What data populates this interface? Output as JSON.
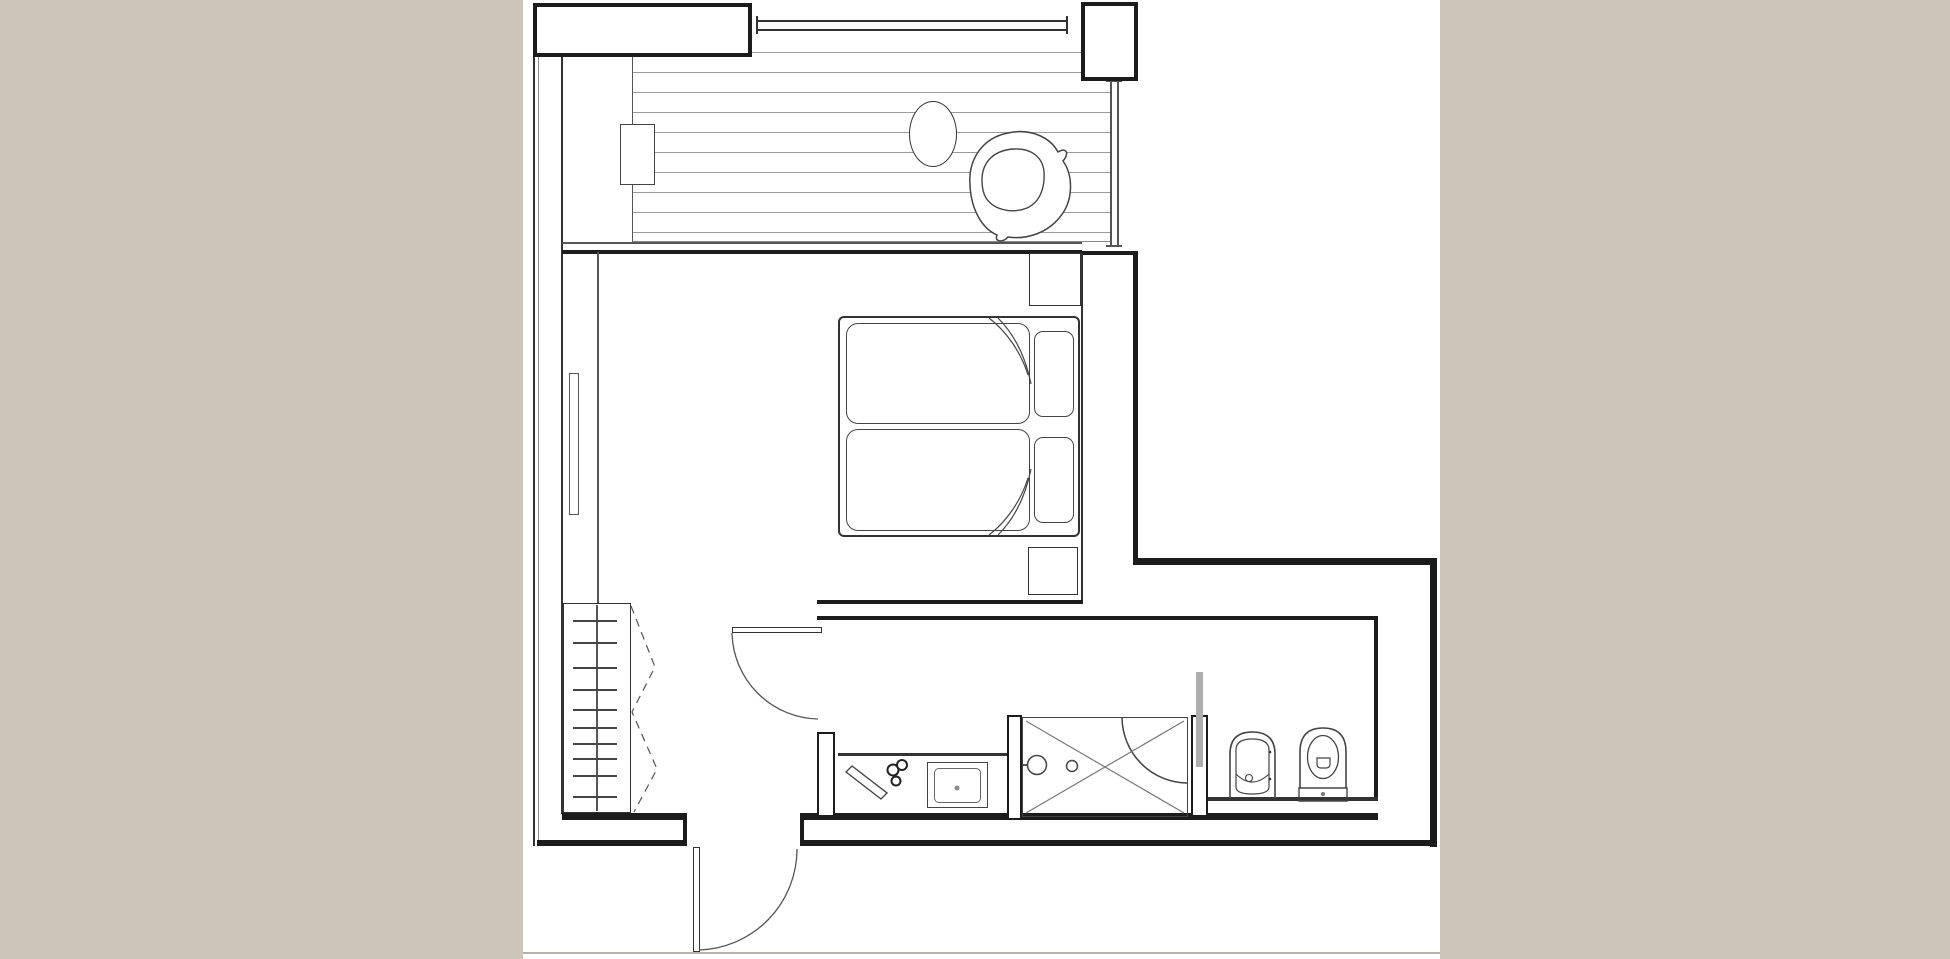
{
  "meta": {
    "kind": "architectural-floor-plan",
    "description": "Black and white studio-apartment floor plan on white paper with warm grey margins; no text labels are rendered in the image",
    "rooms": [
      "balcony-terrace",
      "bedroom",
      "wardrobe-corridor",
      "entry-hall",
      "vanity-niche",
      "shower-area",
      "wc-room"
    ]
  },
  "palette": {
    "page_bg": "#cdc5b7",
    "paper": "#ffffff",
    "wall": "#1c1c1c",
    "wall2": "#333333",
    "medium": "#555555",
    "light": "#8c8c8c",
    "deck_line": "#9b9b9b",
    "glass": "#b0adad",
    "scan": "#b9b3a7",
    "furn": "#444444",
    "thin": "#777777"
  },
  "canvas": {
    "x": 523,
    "y": 0,
    "w": 917,
    "h": 959
  },
  "drawing": {
    "rects": [
      {
        "name": "balcony-decking",
        "x": 632,
        "y": 33,
        "w": 478,
        "h": 209,
        "deck": true,
        "bl": "1.5px solid #555555",
        "bb": "1px solid #888888"
      },
      {
        "name": "balcony-side-table",
        "x": 620,
        "y": 124,
        "w": 35,
        "h": 61,
        "fill": "paper",
        "b": "1.5px solid #444444"
      },
      {
        "name": "wall-block-top-left",
        "x": 533,
        "y": 3,
        "w": 219,
        "h": 54,
        "fill": "paper",
        "b": "4px solid wall"
      },
      {
        "name": "wall-pier-top-right",
        "x": 1081,
        "y": 2,
        "w": 57,
        "h": 79,
        "fill": "paper",
        "b": "4px solid wall"
      },
      {
        "name": "bedroom-right-wall",
        "x": 1081,
        "y": 251,
        "w": 57,
        "h": 314,
        "fill": "paper",
        "bl": "2px solid #333333",
        "br": "5px solid wall",
        "bt": "4px solid wall"
      },
      {
        "name": "balcony-round-table",
        "x": 909,
        "y": 101,
        "w": 48,
        "h": 66,
        "fill": "paper",
        "b": "1.5px solid #333333",
        "rx": "50%"
      },
      {
        "name": "bed-frame",
        "x": 838,
        "y": 316,
        "w": 242,
        "h": 221,
        "fill": "paper",
        "b": "2px solid #333333",
        "rx": "6px"
      },
      {
        "name": "mattress-top",
        "x": 846,
        "y": 323,
        "w": 184,
        "h": 101,
        "fill": "paper",
        "b": "1.5px solid furn",
        "rx": "12px"
      },
      {
        "name": "mattress-bottom",
        "x": 846,
        "y": 429,
        "w": 184,
        "h": 102,
        "fill": "paper",
        "b": "1.5px solid furn",
        "rx": "12px"
      },
      {
        "name": "pillow-top",
        "x": 1034,
        "y": 331,
        "w": 40,
        "h": 86,
        "fill": "paper",
        "b": "1.5px solid furn",
        "rx": "9px"
      },
      {
        "name": "pillow-bottom",
        "x": 1034,
        "y": 437,
        "w": 40,
        "h": 86,
        "fill": "paper",
        "b": "1.5px solid furn",
        "rx": "9px"
      },
      {
        "name": "nightstand-top",
        "x": 1029,
        "y": 253,
        "w": 52,
        "h": 53,
        "fill": "paper",
        "b": "1.5px solid #333333"
      },
      {
        "name": "nightstand-bottom",
        "x": 1028,
        "y": 547,
        "w": 50,
        "h": 48,
        "fill": "paper",
        "b": "1.5px solid #333333"
      },
      {
        "name": "wardrobe",
        "x": 563,
        "y": 603,
        "w": 68,
        "h": 210,
        "fill": "paper",
        "b": "1.5px solid #333333"
      },
      {
        "name": "radiator-left-wall",
        "x": 569,
        "y": 373,
        "w": 10,
        "h": 142,
        "fill": "paper",
        "b": "1px solid #555555"
      },
      {
        "name": "wall-pier-vanity-left",
        "x": 817,
        "y": 732,
        "w": 18,
        "h": 85,
        "fill": "paper",
        "b": "2.5px solid wall"
      },
      {
        "name": "wall-pier-shower-left",
        "x": 1007,
        "y": 715,
        "w": 15,
        "h": 105,
        "fill": "paper",
        "b": "2.5px solid wall"
      },
      {
        "name": "wall-stub-shower-right",
        "x": 1191,
        "y": 715,
        "w": 17,
        "h": 102,
        "fill": "paper",
        "b": "2.5px solid wall"
      },
      {
        "name": "glass-partition",
        "x": 1196,
        "y": 672,
        "w": 7,
        "h": 95,
        "fill": "glass"
      },
      {
        "name": "shower-basin",
        "x": 1022,
        "y": 717,
        "w": 166,
        "h": 100,
        "b": "1.5px solid furn"
      },
      {
        "name": "sink-outer",
        "x": 927,
        "y": 762,
        "w": 61,
        "h": 46,
        "fill": "paper",
        "b": "1.5px solid furn"
      },
      {
        "name": "sink-inner",
        "x": 934,
        "y": 768,
        "w": 47,
        "h": 35,
        "fill": "paper",
        "b": "1px solid #666666",
        "rx": "5px"
      },
      {
        "name": "entrance-door-leaf",
        "x": 693,
        "y": 847,
        "w": 7,
        "h": 105,
        "fill": "paper",
        "b": "1.5px solid #333333"
      },
      {
        "name": "bedroom-door-leaf",
        "x": 732,
        "y": 627,
        "w": 90,
        "h": 6,
        "fill": "paper",
        "b": "1.5px solid #333333"
      }
    ],
    "lines": [
      {
        "name": "wall-left-outer-a",
        "x": 533,
        "y": 57,
        "w": 2,
        "h": 789,
        "c": "wall2"
      },
      {
        "name": "wall-left-outer-b",
        "x": 538,
        "y": 57,
        "w": 1,
        "h": 789,
        "c": "light"
      },
      {
        "name": "wall-left-inner",
        "x": 561,
        "y": 57,
        "w": 2,
        "h": 757,
        "c": "wall2"
      },
      {
        "name": "balcony-window-wall-thin",
        "x": 562,
        "y": 242,
        "w": 520,
        "h": 1.5,
        "c": "medium"
      },
      {
        "name": "balcony-window-wall-main",
        "x": 562,
        "y": 250,
        "w": 520,
        "h": 4,
        "c": "wall"
      },
      {
        "name": "balcony-railing-top-a",
        "x": 757,
        "y": 20,
        "w": 310,
        "h": 2,
        "c": "wall2"
      },
      {
        "name": "balcony-railing-top-b",
        "x": 757,
        "y": 29,
        "w": 310,
        "h": 2,
        "c": "wall2"
      },
      {
        "name": "railing-end-cap-left",
        "x": 756,
        "y": 16,
        "w": 2,
        "h": 18,
        "c": "wall2"
      },
      {
        "name": "railing-end-cap-right",
        "x": 1066,
        "y": 16,
        "w": 2,
        "h": 18,
        "c": "wall2"
      },
      {
        "name": "balcony-glass-right-a",
        "x": 1110,
        "y": 81,
        "w": 1.5,
        "h": 166,
        "c": "medium"
      },
      {
        "name": "balcony-glass-right-b",
        "x": 1117,
        "y": 81,
        "w": 1.5,
        "h": 166,
        "c": "medium"
      },
      {
        "name": "balcony-glass-cap-top",
        "x": 1106,
        "y": 80,
        "w": 16,
        "h": 2,
        "c": "medium"
      },
      {
        "name": "balcony-glass-cap-bottom",
        "x": 1106,
        "y": 245,
        "w": 16,
        "h": 2,
        "c": "medium"
      },
      {
        "name": "wall-top-right-extension",
        "x": 1137,
        "y": 558,
        "w": 300,
        "h": 7,
        "c": "wall"
      },
      {
        "name": "wall-right-exterior",
        "x": 1430,
        "y": 558,
        "w": 7,
        "h": 289,
        "c": "wall"
      },
      {
        "name": "hall-wall-top",
        "x": 817,
        "y": 600,
        "w": 266,
        "h": 4,
        "c": "wall"
      },
      {
        "name": "hall-wall-bottom",
        "x": 817,
        "y": 616,
        "w": 561,
        "h": 4,
        "c": "wall"
      },
      {
        "name": "wc-wall-right-inner",
        "x": 1374,
        "y": 620,
        "w": 4,
        "h": 180,
        "c": "wall"
      },
      {
        "name": "wc-plumbing-ledge",
        "x": 1208,
        "y": 797,
        "w": 170,
        "h": 3.5,
        "c": "wall2"
      },
      {
        "name": "wall-bottom-inner-left",
        "x": 562,
        "y": 813,
        "w": 125,
        "h": 7,
        "c": "wall"
      },
      {
        "name": "wall-bottom-inner-right",
        "x": 804,
        "y": 813,
        "w": 574,
        "h": 7,
        "c": "wall"
      },
      {
        "name": "wall-bottom-outer-left",
        "x": 537,
        "y": 840,
        "w": 146,
        "h": 6,
        "c": "wall"
      },
      {
        "name": "wall-bottom-outer-right",
        "x": 800,
        "y": 840,
        "w": 637,
        "h": 6,
        "c": "wall"
      },
      {
        "name": "entrance-jamb-left",
        "x": 683,
        "y": 820,
        "w": 4,
        "h": 26,
        "c": "wall"
      },
      {
        "name": "entrance-jamb-right",
        "x": 800,
        "y": 813,
        "w": 4,
        "h": 33,
        "c": "wall"
      },
      {
        "name": "bedroom-wall-face-lower",
        "x": 1081,
        "y": 565,
        "w": 2,
        "h": 35,
        "c": "wall2"
      },
      {
        "name": "closet-front-line",
        "x": 597,
        "y": 252,
        "w": 1.5,
        "h": 351,
        "c": "medium"
      },
      {
        "name": "vanity-counter-edge",
        "x": 838,
        "y": 753,
        "w": 169,
        "h": 3,
        "c": "wall2"
      },
      {
        "name": "shower-head-stem",
        "x": 1022,
        "y": 764,
        "w": 7,
        "h": 2,
        "c": "medium"
      },
      {
        "name": "scan-edge-bottom",
        "x": 523,
        "y": 952,
        "w": 917,
        "h": 2,
        "c": "scan"
      }
    ],
    "overlines": [
      {
        "name": "wardrobe-center-line",
        "x": 596,
        "y": 605,
        "w": 1.5,
        "h": 206,
        "c": "medium"
      },
      {
        "name": "wardrobe-hanger-tick",
        "x": 573,
        "y": 620,
        "w": 44,
        "h": 1.5,
        "c": "furn"
      },
      {
        "name": "wardrobe-hanger-tick",
        "x": 573,
        "y": 642,
        "w": 44,
        "h": 1.5,
        "c": "furn"
      },
      {
        "name": "wardrobe-hanger-tick",
        "x": 573,
        "y": 667,
        "w": 44,
        "h": 1.5,
        "c": "furn"
      },
      {
        "name": "wardrobe-hanger-tick",
        "x": 573,
        "y": 689,
        "w": 44,
        "h": 1.5,
        "c": "furn"
      },
      {
        "name": "wardrobe-hanger-tick",
        "x": 573,
        "y": 709,
        "w": 44,
        "h": 1.5,
        "c": "furn"
      },
      {
        "name": "wardrobe-hanger-tick",
        "x": 573,
        "y": 727,
        "w": 44,
        "h": 1.5,
        "c": "furn"
      },
      {
        "name": "wardrobe-hanger-tick",
        "x": 573,
        "y": 743,
        "w": 44,
        "h": 1.5,
        "c": "furn"
      },
      {
        "name": "wardrobe-hanger-tick",
        "x": 573,
        "y": 758,
        "w": 44,
        "h": 1.5,
        "c": "furn"
      },
      {
        "name": "wardrobe-hanger-tick",
        "x": 573,
        "y": 775,
        "w": 44,
        "h": 1.5,
        "c": "furn"
      },
      {
        "name": "wardrobe-hanger-tick",
        "x": 573,
        "y": 796,
        "w": 44,
        "h": 1.5,
        "c": "furn"
      }
    ],
    "paths": [
      {
        "name": "bedroom-door-swing",
        "d": "M732,633 A88,88 0 0 0 818,719",
        "s": "medium",
        "sw": 1.3
      },
      {
        "name": "entrance-door-swing",
        "d": "M699,950 A101,101 0 0 0 797,849",
        "s": "medium",
        "sw": 1.3
      },
      {
        "name": "shower-door-swing",
        "d": "M1122,718 A66,66 0 0 0 1187,783",
        "s": "furn",
        "sw": 1.5
      },
      {
        "name": "wardrobe-door-swing-dashed",
        "d": "M631,606 L655,667 L632,712 L657,769 L634,812",
        "s": "medium",
        "sw": 1.2,
        "dash": "8 6"
      },
      {
        "name": "shower-x-line",
        "d": "M1026,721 L1184,813",
        "s": "thin",
        "sw": 1.2
      },
      {
        "name": "shower-x-line",
        "d": "M1026,813 L1184,721",
        "s": "thin",
        "sw": 1.2
      },
      {
        "name": "blanket-fold-top",
        "d": "M989,318 C1006,331 1021,352 1028,375",
        "s": "furn",
        "sw": 1.2
      },
      {
        "name": "blanket-fold-top",
        "d": "M998,318 C1013,333 1025,354 1031,384",
        "s": "furn",
        "sw": 1.2
      },
      {
        "name": "blanket-fold-bottom",
        "d": "M989,535 C1006,522 1021,501 1028,478",
        "s": "furn",
        "sw": 1.2
      },
      {
        "name": "blanket-fold-bottom",
        "d": "M998,535 C1013,520 1025,499 1031,469",
        "s": "furn",
        "sw": 1.2
      },
      {
        "name": "towel-on-counter",
        "d": "M846,772 L881,799 L887,793 L852,766 Z",
        "s": "furn",
        "sw": 1.4,
        "f": "paper"
      },
      {
        "name": "armchair-outer",
        "d": "M970,185 C968,160 982,138 1008,133 C1030,128 1050,137 1058,152 C1066,147 1070,153 1063,161 C1073,175 1074,200 1060,217 C1048,232 1028,240 1008,237 C1003,243 994,242 997,235 C981,228 971,208 970,185 Z",
        "s": "furn",
        "sw": 1.5,
        "f": "paper"
      },
      {
        "name": "armchair-seat",
        "d": "M982,180 C982,162 994,150 1014,149 C1032,148 1043,158 1044,172 C1045,188 1040,202 1027,208 C1012,214 994,210 986,198 C983,193 982,187 982,180 Z",
        "s": "furn",
        "sw": 1.4,
        "f": "paper"
      },
      {
        "name": "toilet-bowl-outline",
        "d": "M1300,788 L1300,752 Q1300,728 1323,728 Q1346,728 1346,752 L1346,788",
        "s": "furn",
        "sw": 1.6
      },
      {
        "name": "toilet-base",
        "d": "M1299,788 L1347,788 L1347,801 L1299,801 Z",
        "s": "furn",
        "sw": 1.4
      },
      {
        "name": "toilet-flush-plate",
        "d": "M1317,758 L1330,758 L1330,764 Q1330,768 1326,768 L1321,768 Q1317,768 1317,764 Z",
        "s": "furn",
        "sw": 1.2
      },
      {
        "name": "bidet-outline",
        "d": "M1230,799 L1230,754 Q1230,732 1252,732 Q1275,732 1275,754 L1275,799",
        "s": "furn",
        "sw": 1.6
      },
      {
        "name": "bidet-inner",
        "d": "M1236,787 L1236,750 Q1236,739 1252,739 Q1269,739 1269,750 L1269,787 Q1269,794 1252,794 Q1236,794 1236,787 Z",
        "s": "furn",
        "sw": 1.2
      },
      {
        "name": "bidet-waterline",
        "d": "M1236,774 Q1252,790 1269,774",
        "s": "furn",
        "sw": 1.1
      }
    ],
    "circles": [
      {
        "name": "shower-drain",
        "cx": 1072,
        "cy": 766,
        "r": 5.5,
        "s": "furn",
        "sw": 1.5,
        "f": "paper"
      },
      {
        "name": "shower-head",
        "cx": 1037,
        "cy": 765,
        "r": 9.5,
        "s": "furn",
        "sw": 1.5,
        "f": "paper"
      },
      {
        "name": "sink-drain-dot",
        "cx": 957,
        "cy": 788,
        "r": 2.5,
        "f": "light"
      },
      {
        "name": "counter-accessory",
        "cx": 893,
        "cy": 770,
        "r": 5.5,
        "s": "#222222",
        "sw": 2,
        "f": "paper"
      },
      {
        "name": "counter-accessory",
        "cx": 902,
        "cy": 765,
        "r": 5,
        "s": "#222222",
        "sw": 2,
        "f": "paper"
      },
      {
        "name": "counter-accessory",
        "cx": 896,
        "cy": 781,
        "r": 4.5,
        "s": "#222222",
        "sw": 2,
        "f": "paper"
      },
      {
        "name": "toilet-seat-inner",
        "cx": 1323,
        "cy": 757,
        "r": 0,
        "rx": 15.5,
        "ry": 21.5,
        "s": "furn",
        "sw": 1.3
      },
      {
        "name": "toilet-base-dot",
        "cx": 1323,
        "cy": 794,
        "r": 2,
        "f": "thin"
      },
      {
        "name": "bidet-drain",
        "cx": 1249,
        "cy": 778,
        "r": 3.5,
        "s": "furn",
        "sw": 1.1,
        "f": "paper"
      },
      {
        "name": "bidet-rim-dot",
        "cx": 1270,
        "cy": 752,
        "r": 1.3,
        "f": "#333333"
      },
      {
        "name": "bidet-rim-dot",
        "cx": 1270,
        "cy": 779,
        "r": 1.3,
        "f": "#333333"
      }
    ]
  }
}
